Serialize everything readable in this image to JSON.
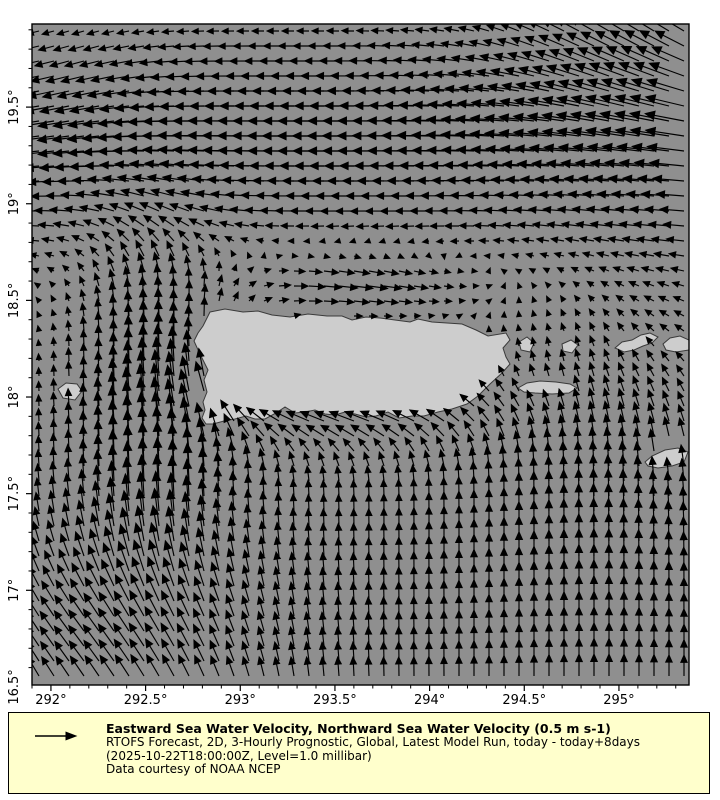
{
  "legend": {
    "title": "Eastward Sea Water Velocity, Northward Sea Water Velocity (0.5 m s-1)",
    "line2": "RTOFS Forecast, 2D, 3-Hourly Prognostic, Global, Latest Model Run, today - today+8days",
    "line3": "(2025-10-22T18:00:00Z, Level=1.0 millibar)",
    "line4": "Data courtesy of NOAA NCEP",
    "reference_vector_label": "0.5 m s-1"
  },
  "chart_data": {
    "type": "quiver",
    "title": "Eastward Sea Water Velocity, Northward Sea Water Velocity",
    "units": "m s-1",
    "reference_vector_ms": 0.5,
    "lon_range": [
      291.9,
      295.37
    ],
    "lat_range": [
      16.51,
      19.93
    ],
    "x_ticks": {
      "values": [
        292,
        292.5,
        293,
        293.5,
        294,
        294.5,
        295
      ],
      "labels": [
        "292°",
        "292.5°",
        "293°",
        "293.5°",
        "294°",
        "294.5°",
        "295°"
      ]
    },
    "y_ticks": {
      "values": [
        16.5,
        17,
        17.5,
        18,
        18.5,
        19,
        19.5
      ],
      "labels": [
        "16.5°",
        "17°",
        "17.5°",
        "18°",
        "18.5°",
        "19°",
        "19.5°"
      ]
    },
    "minor_tick_step_deg": 0.1,
    "grid_step_px": 15,
    "arrow_scale_px_per_ms": 78,
    "colors": {
      "ocean": "#8f8f8f",
      "land": "#cdcdcd",
      "coast": "#3a3a3a",
      "arrow": "#000000",
      "frame": "#000000",
      "legend_bg": "#ffffcc"
    },
    "flow_features": {
      "u_terms": [
        {
          "name": "westward-jet-north-of-island",
          "amp": -0.4,
          "lat_c": 19.35,
          "lat_s": 0.55
        },
        {
          "name": "northwestward-top-right",
          "amp": -0.18,
          "lat_c": 19.9,
          "lat_s": 0.6,
          "lon_c": 295.2,
          "lon_s": 0.8
        },
        {
          "name": "eastward-countercurrent-north-coast",
          "amp": 0.3,
          "lat_c": 18.6,
          "lat_s": 0.2,
          "lon_c": 293.6,
          "lon_s": 0.65
        },
        {
          "name": "westward-jet-south-coast",
          "amp": -0.33,
          "lat_c": 17.93,
          "lat_s": 0.22,
          "lon_c": 293.6,
          "lon_s": 0.8
        },
        {
          "name": "northwestward-bottom-left",
          "amp": -0.2,
          "lat_c": 16.75,
          "lat_s": 0.55,
          "lon_c": 292.3,
          "lon_s": 0.8
        },
        {
          "name": "weak-westward-east-edge",
          "amp": -0.1,
          "lat_c": 18.35,
          "lat_s": 0.7,
          "lon_c": 295.35,
          "lon_s": 0.5
        }
      ],
      "v_terms": [
        {
          "name": "strong-northward-west-of-island",
          "amp": 0.45,
          "lat_c": 17.95,
          "lat_s": 0.85,
          "lon_c": 292.55,
          "lon_s": 0.4
        },
        {
          "name": "northward-east-of-islands",
          "amp": 0.15,
          "lat_c": 17.6,
          "lat_s": 0.9,
          "lon_c": 294.9,
          "lon_s": 0.7
        },
        {
          "name": "northward-top-right",
          "amp": 0.2,
          "lat_c": 19.9,
          "lat_s": 0.55,
          "lon_c": 295.2,
          "lon_s": 0.8
        },
        {
          "name": "slight-southward-top-left-curl",
          "amp": -0.08,
          "lat_c": 19.55,
          "lat_s": 0.45,
          "lon_c": 292.15,
          "lon_s": 0.5
        },
        {
          "name": "slight-southward-tilt-countercurrent",
          "amp": -0.05,
          "lat_c": 18.6,
          "lat_s": 0.25,
          "lon_c": 293.8,
          "lon_s": 0.6
        }
      ],
      "v_base_south": {
        "name": "broad-northward-flow-south-half",
        "amp": 0.24,
        "lat_mid": 17.85,
        "lat_width": 0.5
      }
    },
    "land_px": {
      "puerto_rico": [
        [
          210,
          312
        ],
        [
          225,
          309
        ],
        [
          243,
          312
        ],
        [
          258,
          311
        ],
        [
          272,
          315
        ],
        [
          290,
          317
        ],
        [
          308,
          314
        ],
        [
          327,
          316
        ],
        [
          342,
          316
        ],
        [
          352,
          320
        ],
        [
          366,
          317
        ],
        [
          380,
          318
        ],
        [
          395,
          320
        ],
        [
          410,
          322
        ],
        [
          418,
          319
        ],
        [
          432,
          322
        ],
        [
          447,
          323
        ],
        [
          462,
          324
        ],
        [
          476,
          330
        ],
        [
          488,
          336
        ],
        [
          506,
          333
        ],
        [
          510,
          340
        ],
        [
          503,
          348
        ],
        [
          506,
          357
        ],
        [
          510,
          364
        ],
        [
          502,
          373
        ],
        [
          490,
          384
        ],
        [
          478,
          396
        ],
        [
          467,
          404
        ],
        [
          452,
          409
        ],
        [
          438,
          412
        ],
        [
          424,
          416
        ],
        [
          412,
          416
        ],
        [
          399,
          418
        ],
        [
          388,
          412
        ],
        [
          376,
          416
        ],
        [
          366,
          417
        ],
        [
          355,
          414
        ],
        [
          345,
          412
        ],
        [
          335,
          415
        ],
        [
          325,
          414
        ],
        [
          315,
          410
        ],
        [
          305,
          412
        ],
        [
          295,
          413
        ],
        [
          285,
          407
        ],
        [
          276,
          413
        ],
        [
          265,
          419
        ],
        [
          255,
          419
        ],
        [
          246,
          416
        ],
        [
          235,
          419
        ],
        [
          224,
          421
        ],
        [
          213,
          424
        ],
        [
          206,
          424
        ],
        [
          202,
          418
        ],
        [
          205,
          410
        ],
        [
          203,
          402
        ],
        [
          207,
          392
        ],
        [
          204,
          380
        ],
        [
          208,
          370
        ],
        [
          204,
          362
        ],
        [
          199,
          352
        ],
        [
          194,
          341
        ],
        [
          198,
          333
        ],
        [
          203,
          326
        ],
        [
          207,
          318
        ]
      ],
      "mona_island": [
        [
          58,
          389
        ],
        [
          66,
          383
        ],
        [
          77,
          384
        ],
        [
          82,
          391
        ],
        [
          75,
          400
        ],
        [
          63,
          398
        ]
      ],
      "vieques": [
        [
          518,
          388
        ],
        [
          527,
          383
        ],
        [
          540,
          381
        ],
        [
          556,
          382
        ],
        [
          570,
          384
        ],
        [
          577,
          388
        ],
        [
          569,
          393
        ],
        [
          552,
          394
        ],
        [
          535,
          393
        ],
        [
          524,
          392
        ]
      ],
      "islet_east_of_pr": [
        [
          519,
          342
        ],
        [
          527,
          337
        ],
        [
          534,
          343
        ],
        [
          530,
          352
        ],
        [
          521,
          350
        ]
      ],
      "culebra": [
        [
          562,
          344
        ],
        [
          571,
          340
        ],
        [
          578,
          345
        ],
        [
          572,
          353
        ],
        [
          563,
          351
        ]
      ],
      "st_thomas_chain": [
        [
          615,
          348
        ],
        [
          622,
          342
        ],
        [
          632,
          340
        ],
        [
          641,
          335
        ],
        [
          650,
          333
        ],
        [
          658,
          337
        ],
        [
          652,
          343
        ],
        [
          643,
          346
        ],
        [
          634,
          350
        ],
        [
          624,
          352
        ]
      ],
      "tortola_group": [
        [
          663,
          344
        ],
        [
          670,
          338
        ],
        [
          680,
          336
        ],
        [
          689,
          340
        ],
        [
          689,
          350
        ],
        [
          676,
          352
        ],
        [
          666,
          350
        ]
      ],
      "st_croix": [
        [
          645,
          462
        ],
        [
          652,
          456
        ],
        [
          665,
          450
        ],
        [
          678,
          448
        ],
        [
          688,
          452
        ],
        [
          684,
          462
        ],
        [
          672,
          466
        ],
        [
          658,
          468
        ],
        [
          648,
          466
        ]
      ]
    }
  }
}
